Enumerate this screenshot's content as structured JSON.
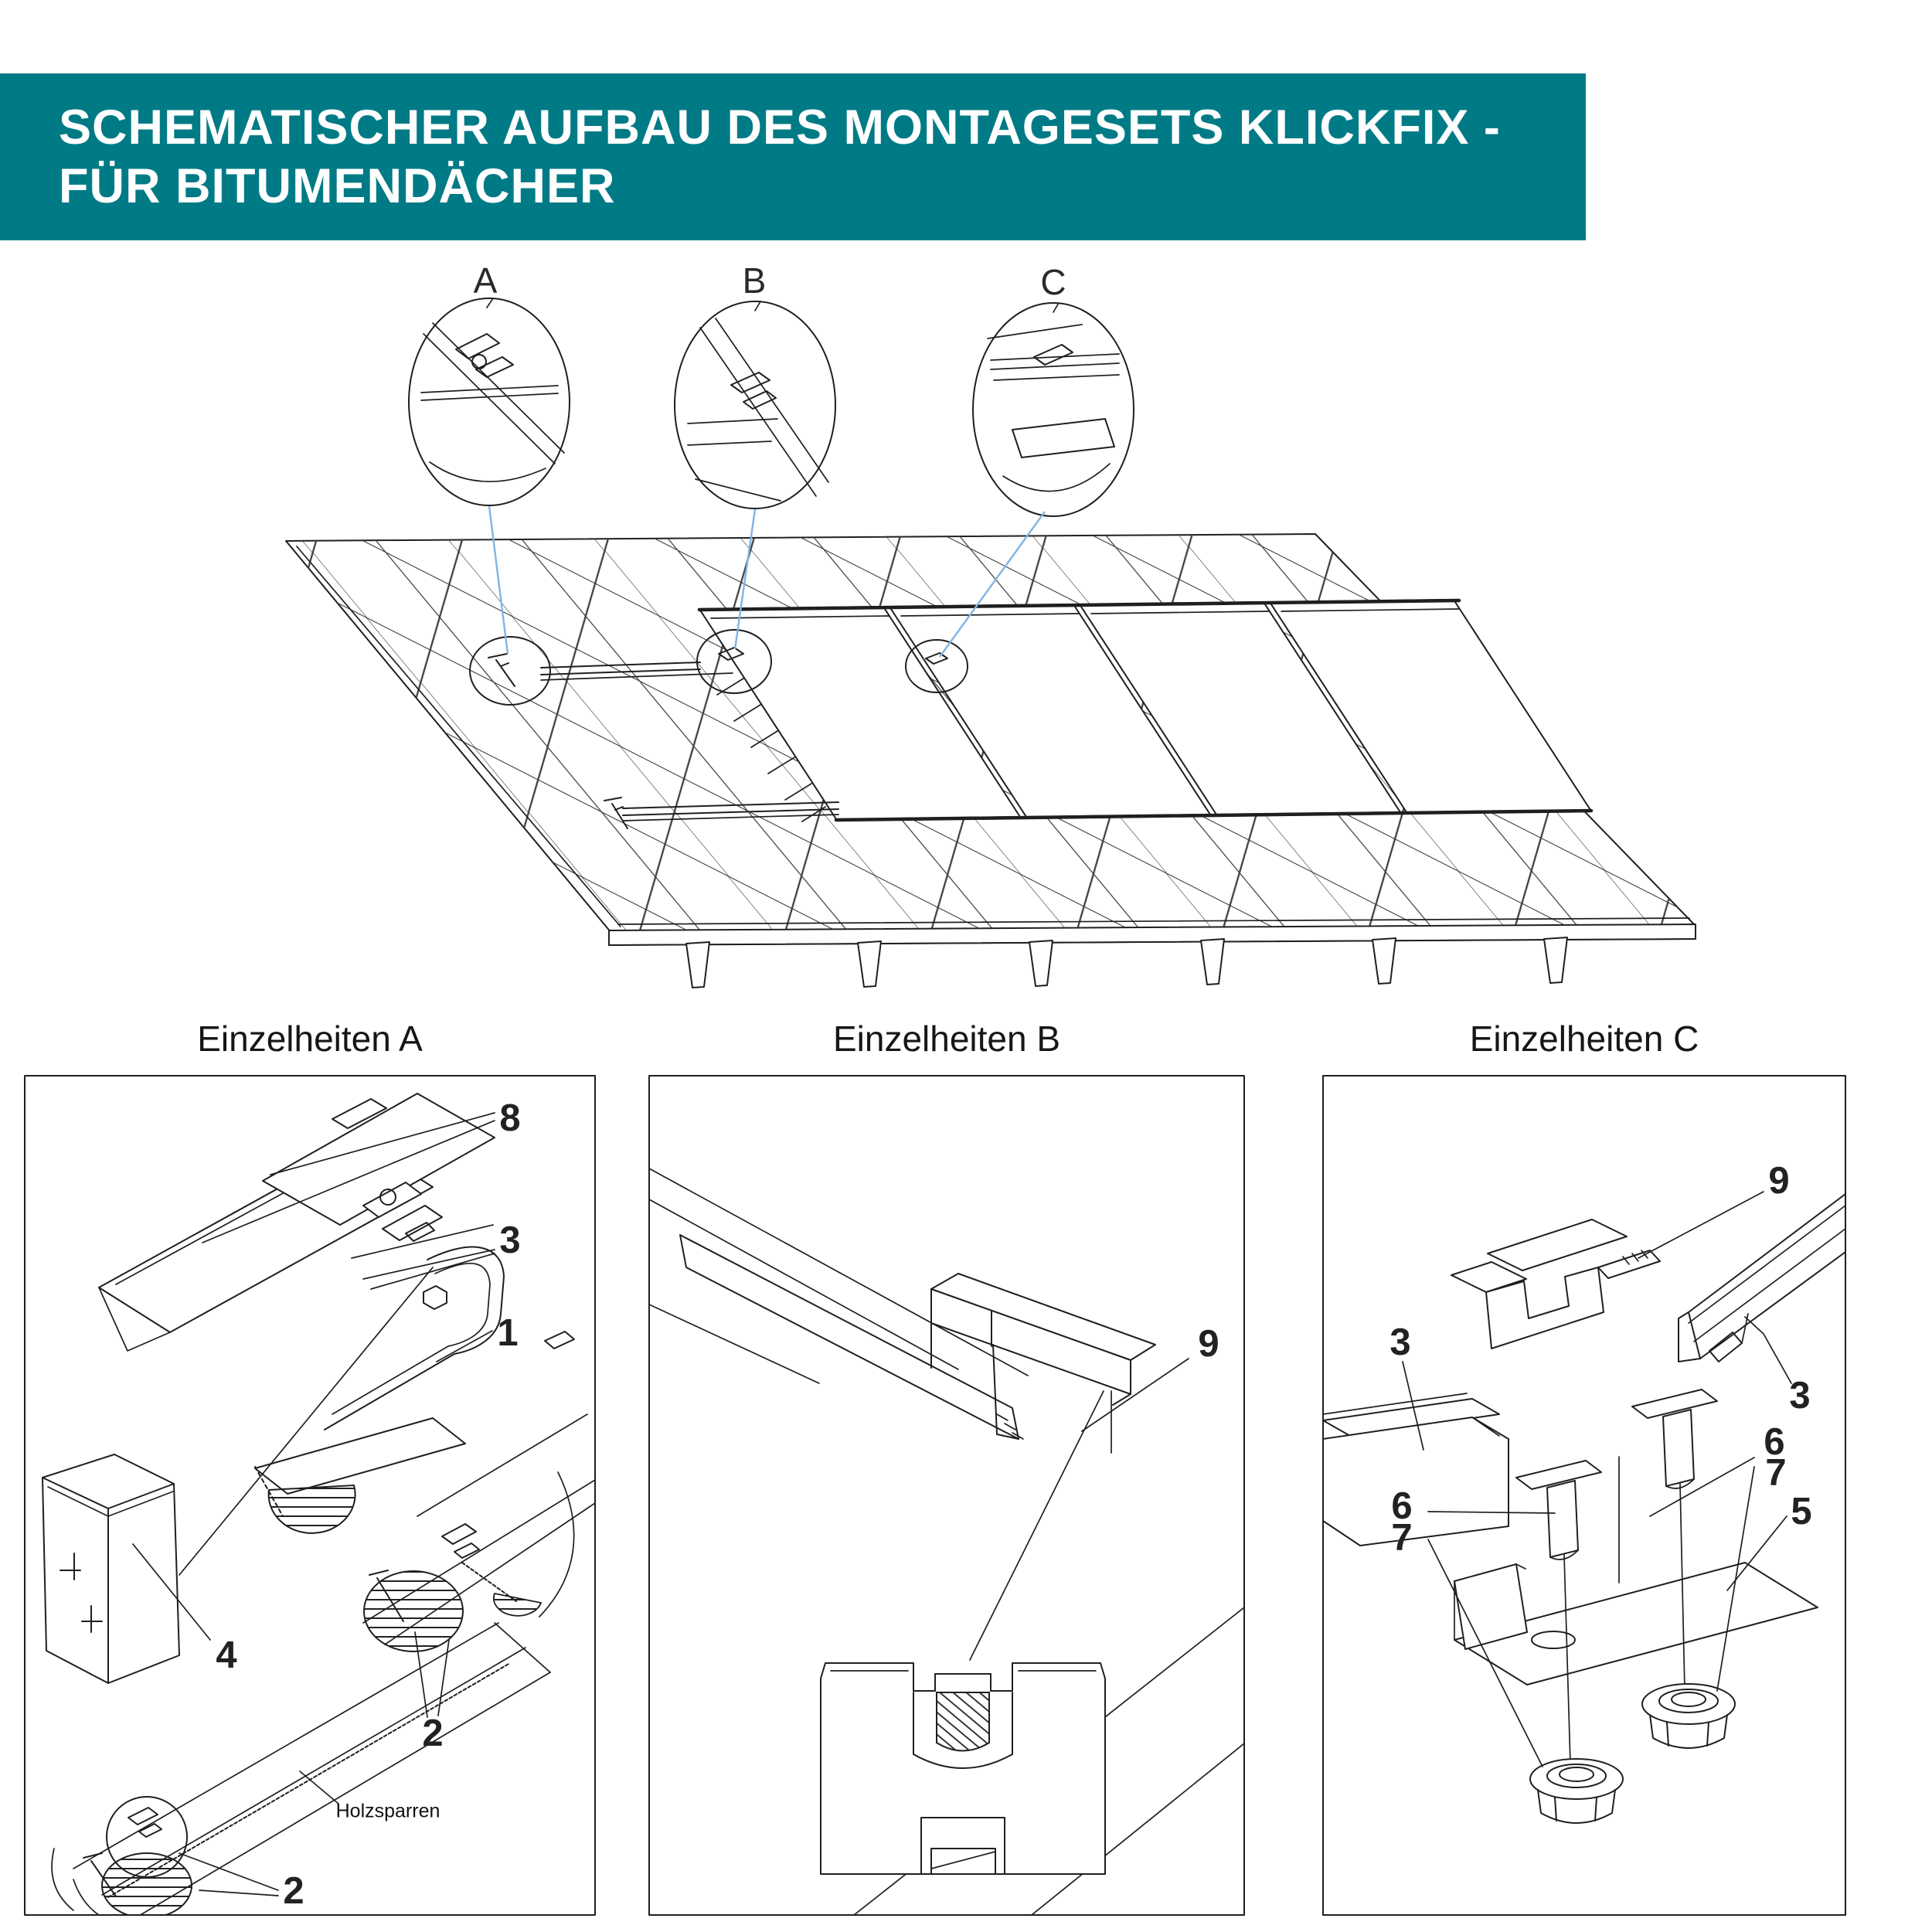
{
  "header": {
    "title_line1": "SCHEMATISCHER AUFBAU DES MONTAGESETS KLICKFIX -",
    "title_line2": "FÜR BITUMENDÄCHER"
  },
  "overview": {
    "detail_a": "A",
    "detail_b": "B",
    "detail_c": "C"
  },
  "panels": {
    "a": {
      "title": "Einzelheiten A",
      "callout_8": "8",
      "callout_3": "3",
      "callout_1": "1",
      "callout_4": "4",
      "callout_2_top": "2",
      "callout_2_bottom": "2",
      "note_holzsparren": "Holzsparren"
    },
    "b": {
      "title": "Einzelheiten B",
      "callout_9": "9"
    },
    "c": {
      "title": "Einzelheiten C",
      "callout_9": "9",
      "callout_3_left": "3",
      "callout_3_right": "3",
      "callout_6_right": "6",
      "callout_7_right": "7",
      "callout_5": "5",
      "callout_6_left": "6",
      "callout_7_left": "7"
    }
  },
  "colors": {
    "banner_teal": "#007b86",
    "title_text": "#ffffff",
    "leader_blue": "#82b4e2",
    "ink": "#1f1f1f"
  }
}
